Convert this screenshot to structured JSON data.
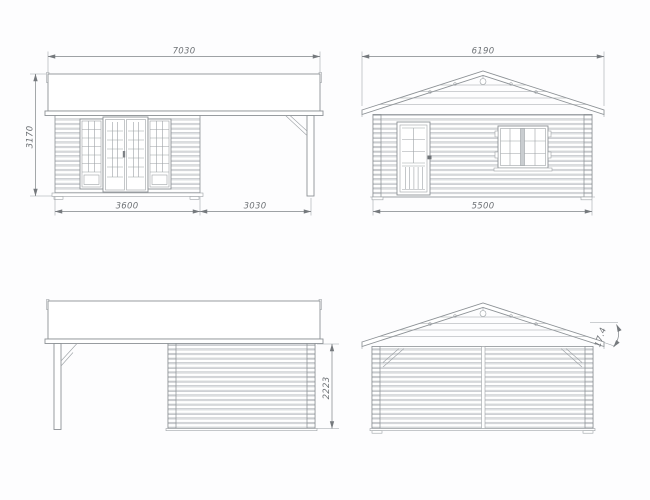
{
  "drawing": {
    "kind": "log cabin elevation drawing, four views",
    "colors": {
      "line": "#8d9296",
      "detail_line": "#9da2a6",
      "dim_text": "#6e7276",
      "background": "#ffffff"
    }
  },
  "views": {
    "front": {
      "label": "front elevation with canopy",
      "dims": {
        "roof_width": "7030",
        "height": "3170",
        "cabin_width": "3600",
        "canopy_width": "3030"
      }
    },
    "side": {
      "label": "side elevation with door and window",
      "dims": {
        "roof_width": "6190",
        "base_width": "5500"
      }
    },
    "rear_side": {
      "label": "rear elevation with canopy",
      "dims": {
        "wall_height": "2223"
      }
    },
    "rear_gable": {
      "label": "rear gable elevation",
      "dims": {
        "roof_pitch_deg": "17.4"
      }
    }
  }
}
